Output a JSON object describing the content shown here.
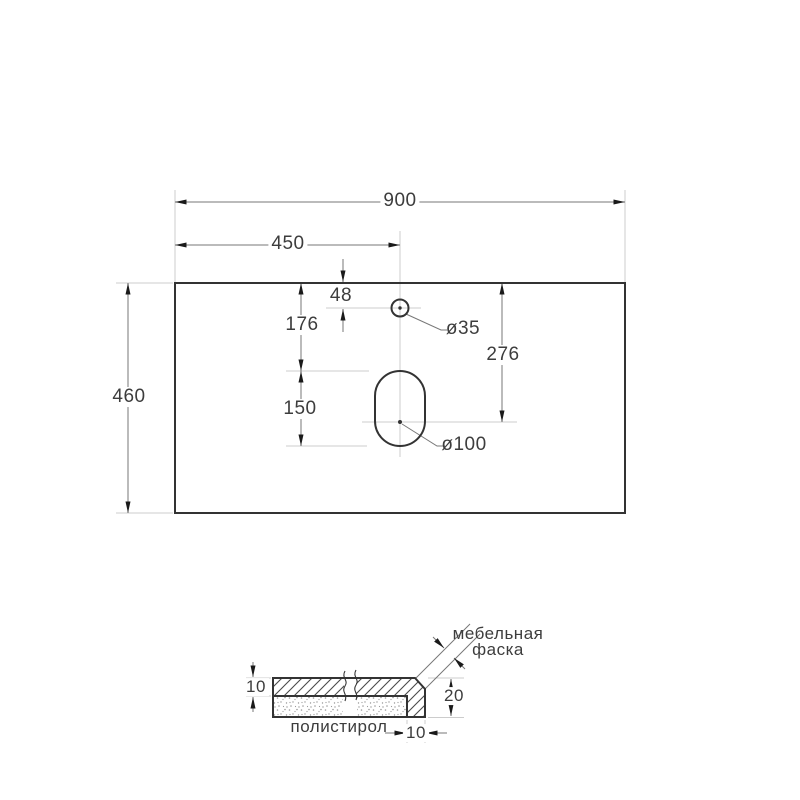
{
  "title": "countertop-technical-drawing",
  "top_view": {
    "width": "900",
    "half_width": "450",
    "depth": "460",
    "faucet_offset": "48",
    "top_to_slot": "176",
    "slot_height": "150",
    "top_to_drain_center": "276",
    "faucet_hole": "ø35",
    "drain_hole": "ø100"
  },
  "section_view": {
    "slab_thickness": "10",
    "edge_height": "20",
    "edge_width": "10",
    "chamfer_line1": "мебельная",
    "chamfer_line2": "фаска",
    "filler": "полистирол"
  },
  "colors": {
    "outline": "#333333",
    "dim_line": "#777777",
    "ext_line": "#cccccc",
    "arrow": "#1a1a1a",
    "text": "#3d3d3d",
    "hatch": "#4a4a4a",
    "stipple": "#999999",
    "background": "#ffffff"
  }
}
